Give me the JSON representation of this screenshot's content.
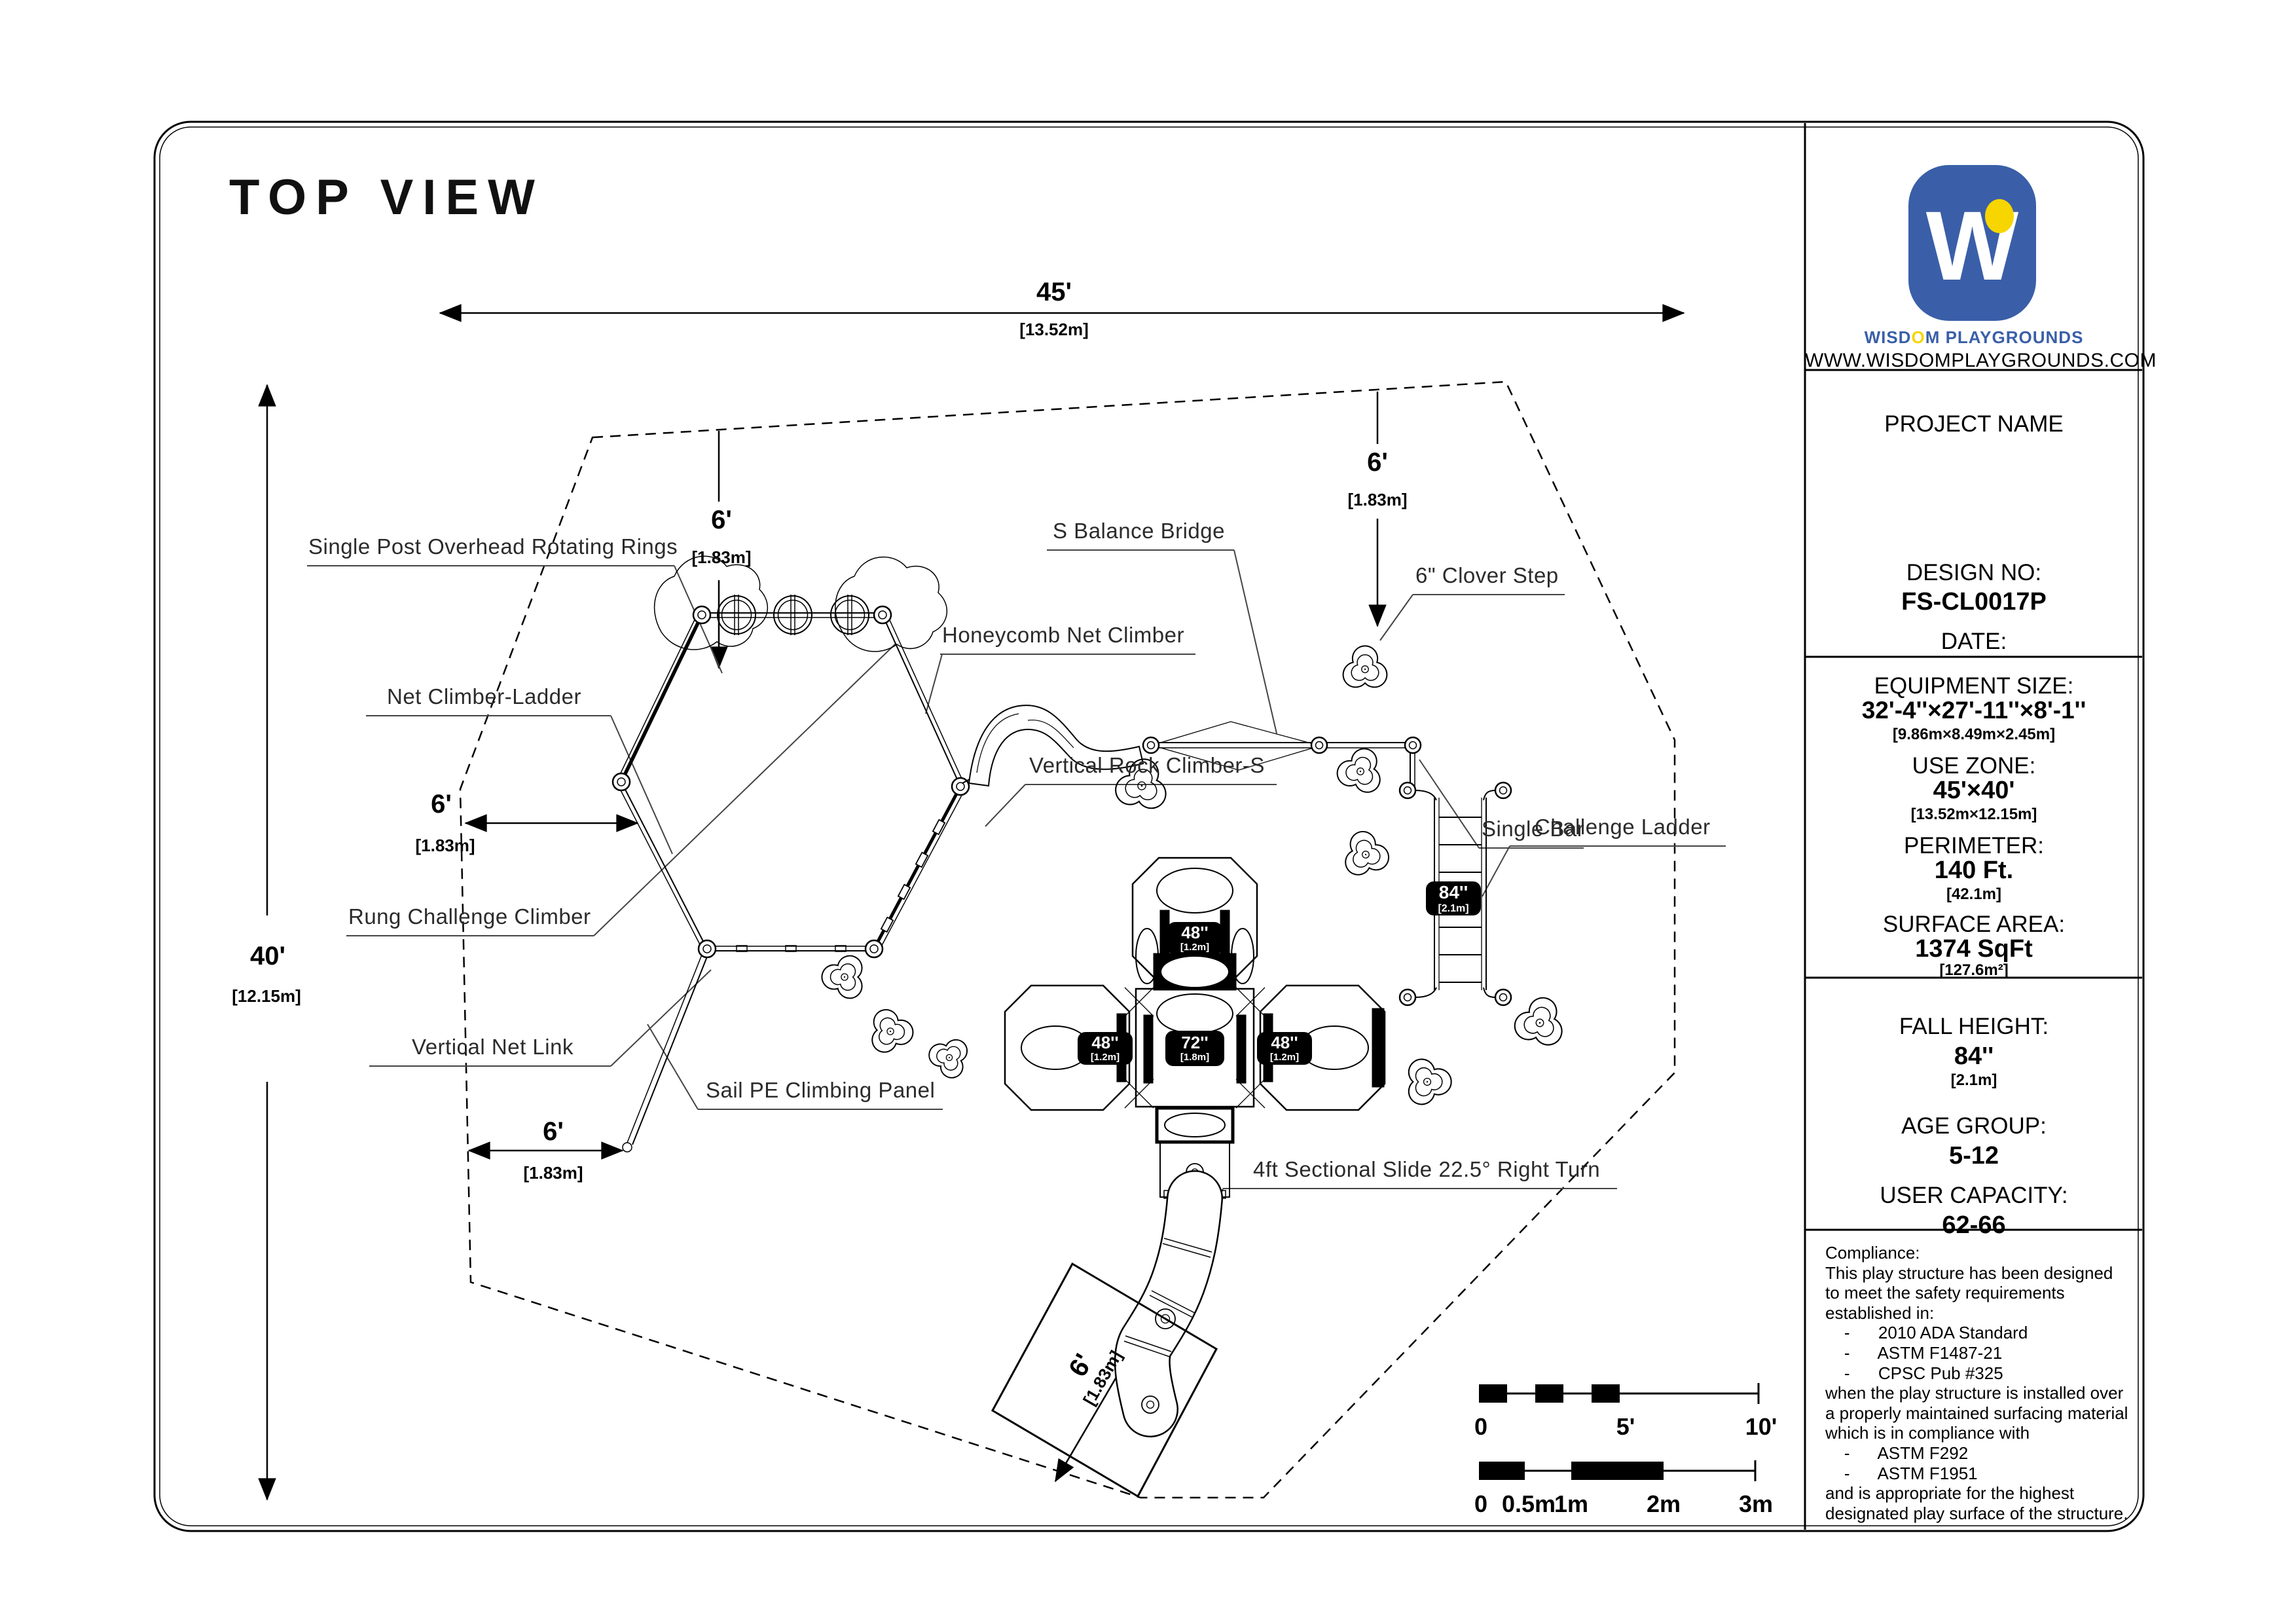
{
  "title": "TOP VIEW",
  "colors": {
    "brand_blue": "#3a5fa8",
    "brand_yellow": "#f7d500",
    "ink": "#000000"
  },
  "logo": {
    "letter": "W",
    "brand_pre": "WISD",
    "brand_o": "O",
    "brand_post": "M PLAYGROUNDS",
    "url": "WWW.WISDOMPLAYGROUNDS.COM"
  },
  "project": {
    "name_label": "PROJECT NAME",
    "design_label": "DESIGN NO:",
    "design_no": "FS-CL0017P",
    "date_label": "DATE:"
  },
  "specs": [
    {
      "label": "EQUIPMENT SIZE:",
      "value": "32'-4''×27'-11''×8'-1''",
      "metric": "[9.86m×8.49m×2.45m]"
    },
    {
      "label": "USE ZONE:",
      "value": "45'×40'",
      "metric": "[13.52m×12.15m]"
    },
    {
      "label": "PERIMETER:",
      "value": "140 Ft.",
      "metric": "[42.1m]"
    },
    {
      "label": "SURFACE AREA:",
      "value": "1374 SqFt",
      "metric": "[127.6m²]"
    }
  ],
  "specs2": [
    {
      "label": "FALL HEIGHT:",
      "value": "84''",
      "metric": "[2.1m]"
    },
    {
      "label": "AGE GROUP:",
      "value": "5-12",
      "metric": ""
    },
    {
      "label": "USER CAPACITY:",
      "value": "62-66",
      "metric": ""
    }
  ],
  "compliance": {
    "lines": [
      "Compliance:",
      "This play structure has been designed",
      "to meet the safety requirements",
      "established in:",
      "    -      2010 ADA Standard",
      "    -      ASTM F1487-21",
      "    -      CPSC Pub #325",
      "when the play structure is installed over",
      "a properly maintained surfacing material",
      "which is in compliance with",
      "    -      ASTM F292",
      "    -      ASTM F1951",
      "and is appropriate for the highest",
      "designated play surface of the structure."
    ]
  },
  "callouts": [
    {
      "text": "Single Post Overhead Rotating Rings"
    },
    {
      "text": "Net Climber-Ladder"
    },
    {
      "text": "Rung Challenge Climber"
    },
    {
      "text": "Vertical Net Link"
    },
    {
      "text": "Sail PE Climbing Panel"
    },
    {
      "text": "Honeycomb Net Climber"
    },
    {
      "text": "S Balance Bridge"
    },
    {
      "text": "Vertical Rock Climber-S"
    },
    {
      "text": "6\" Clover Step"
    },
    {
      "text": "Single Bar"
    },
    {
      "text": "Challenge Ladder"
    },
    {
      "text": "4ft Sectional Slide 22.5° Right Turn"
    }
  ],
  "dimensions": {
    "d45": {
      "v": "45'",
      "m": "[13.52m]"
    },
    "d40": {
      "v": "40'",
      "m": "[12.15m]"
    },
    "d6": {
      "v": "6'",
      "m": "[1.83m]"
    }
  },
  "badges": {
    "b48": {
      "v": "48''",
      "m": "[1.2m]"
    },
    "b72": {
      "v": "72''",
      "m": "[1.8m]"
    },
    "b84": {
      "v": "84''",
      "m": "[2.1m]"
    }
  },
  "scale_ft": {
    "labels": [
      "0",
      "5'",
      "10'"
    ]
  },
  "scale_m": {
    "labels": [
      "0",
      "0.5m",
      "1m",
      "2m",
      "3m"
    ]
  }
}
